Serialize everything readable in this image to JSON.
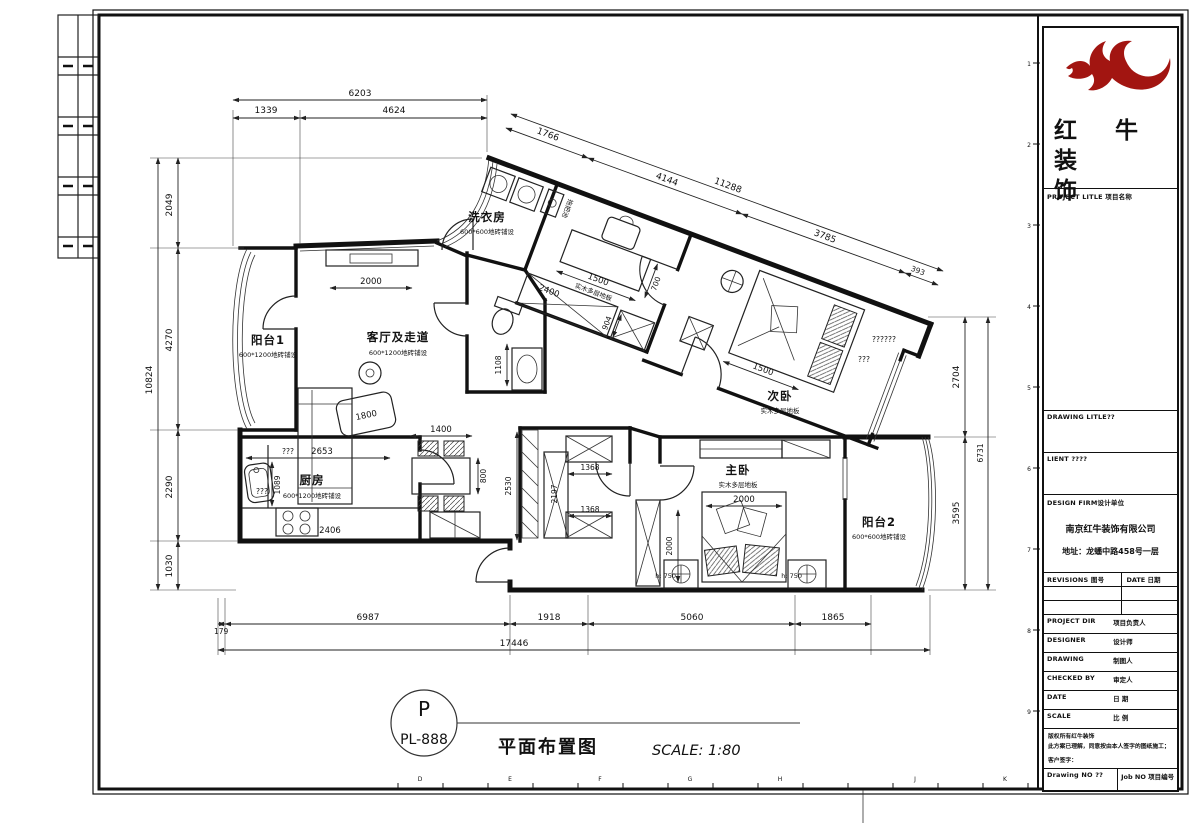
{
  "page": {
    "bottom_letters": [
      "D",
      "E",
      "F",
      "G",
      "H",
      "J",
      "K"
    ],
    "ruler_numbers": [
      "1",
      "2",
      "3",
      "4",
      "5",
      "6",
      "7",
      "8",
      "9"
    ]
  },
  "title_bar": {
    "tag_top": "P",
    "tag_bottom": "PL-888",
    "title": "平面布置图",
    "scale": "SCALE: 1:80"
  },
  "title_block": {
    "logo_color": "#a21511",
    "logo_line1": "红 牛 装",
    "logo_line2": "饰",
    "project_label": "PROJECT LITLE 项目名称",
    "drawing_label": "DRAWING LITLE??",
    "client_label": "LIENT ????",
    "firm_label": "DESIGN FIRM设计单位",
    "firm_name": "南京红牛装饰有限公司",
    "firm_address": "地址：龙蟠中路458号一层",
    "revisions_label": "REVISIONS 图号",
    "rev_date_label": "DATE 日期",
    "rows": [
      {
        "en": "PROJECT DIR",
        "cn": "项目负责人"
      },
      {
        "en": "DESIGNER",
        "cn": "设计师"
      },
      {
        "en": "DRAWING",
        "cn": "制图人"
      },
      {
        "en": "CHECKED BY",
        "cn": "审定人"
      },
      {
        "en": "DATE",
        "cn": "日 期"
      },
      {
        "en": "SCALE",
        "cn": "比 例"
      }
    ],
    "note1": "版权所有红牛装饰",
    "note2": "此方案已理解，同意按由本人签字的图纸施工；",
    "note3": "客户签字：",
    "drawing_no_label": "Drawing NO ??",
    "job_no_label": "Job NO 项目编号"
  },
  "plan": {
    "rooms": {
      "balcony1": {
        "name": "阳台1",
        "sub": "600*1200地砖铺设"
      },
      "living": {
        "name": "客厅及走道",
        "sub": "600*1200地砖铺设"
      },
      "kitchen": {
        "name": "厨房",
        "sub": "600*1200地砖铺设"
      },
      "laundry": {
        "name": "洗衣房",
        "sub": "600*600地砖铺设"
      },
      "study_floor": "实木多层地板",
      "bedroom2": {
        "name": "次卧",
        "sub": "实木多层地板"
      },
      "master": {
        "name": "主卧",
        "sub": "实木多层地板"
      },
      "balcony2": {
        "name": "阳台2",
        "sub": "600*600地砖铺设"
      },
      "mop_sink": "拖把池"
    },
    "dims": {
      "top_overall": "6203",
      "top_a": "1339",
      "top_b": "4624",
      "diag_a": "1766",
      "diag_b": "4144",
      "diag_overall": "11288",
      "diag_c": "3785",
      "diag_d": "393",
      "left_overall": "10824",
      "left_a": "2049",
      "left_b": "4270",
      "left_c": "2290",
      "left_d": "1030",
      "right_a": "2704",
      "right_overall": "6731",
      "right_b": "3595",
      "bottom_a": "179",
      "bottom_b": "6987",
      "bottom_overall": "17446",
      "bottom_c": "1918",
      "bottom_d": "5060",
      "bottom_e": "1865",
      "living_width": "2000",
      "sofa": "1800",
      "bath": "1108",
      "dining_w": "1400",
      "dining_d": "800",
      "kitchen_w": "2653",
      "kitchen_d": "1089",
      "counter": "2406",
      "kitchen_q1": "???",
      "kitchen_q2": "???",
      "study_desk_w": "1500",
      "study_desk_d": "700",
      "study_closet": "2400",
      "study_shaft": "904",
      "closet_h": "2530",
      "closet_inner": "2197",
      "closet_wa": "1368",
      "closet_wb": "1368",
      "bed2_w": "1500",
      "bed2_q1": "??????",
      "bed2_q2": "???",
      "bed_w": "2000",
      "bed_l": "2000",
      "nightstand_a": "h: 750",
      "nightstand_b": "h: 750"
    }
  }
}
